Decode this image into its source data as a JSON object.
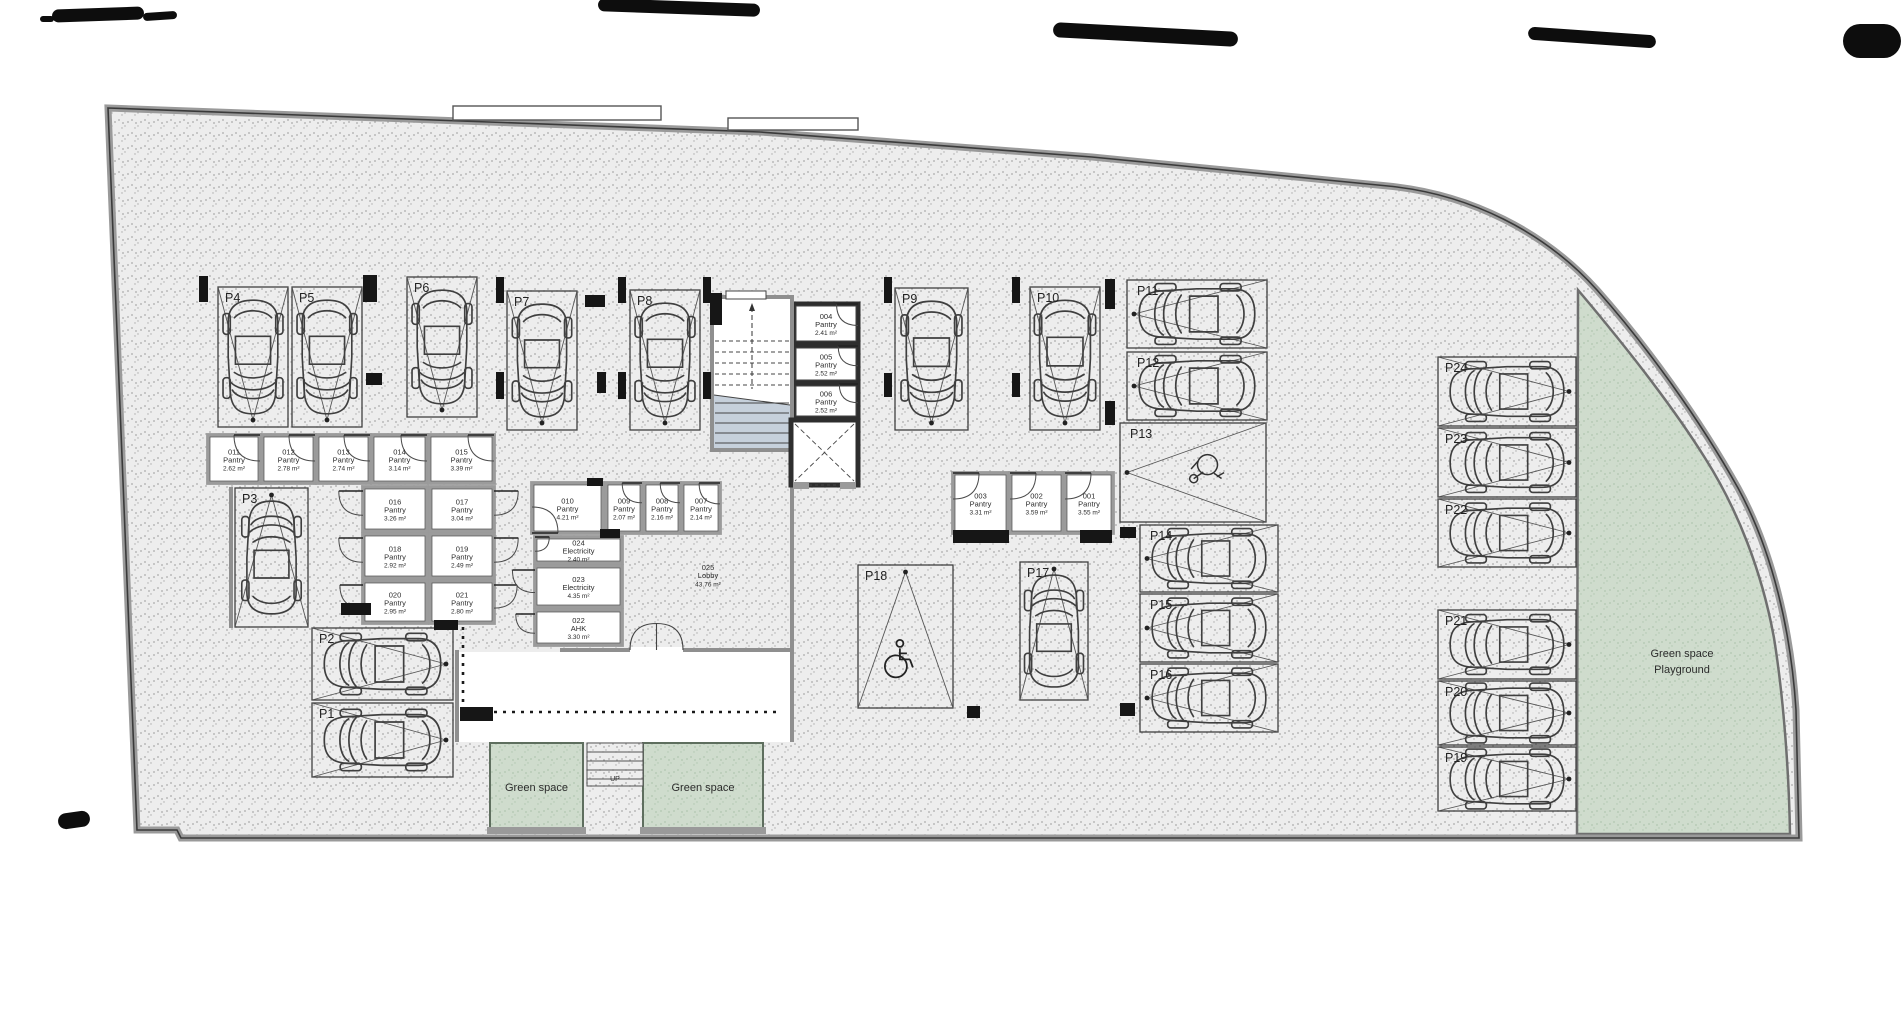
{
  "title": "Basement parking floor plan",
  "canvas": {
    "w": 1904,
    "h": 1010
  },
  "colors": {
    "paper": "#ffffff",
    "floor": "#ededed",
    "floor_dot": "#9a9a9a",
    "green": "#cfdccd",
    "green_dot": "#a9bfa7",
    "wall_gray": "#8f8f8f",
    "wall_dark": "#2e2e2e",
    "line": "#3f3f3f",
    "stair_shade": "#c6d0db",
    "ink": "#2b2b2b"
  },
  "green_playground": {
    "line1": "Green space",
    "line2": "Playground",
    "cx": 1682,
    "cy1": 657,
    "cy2": 673
  },
  "terraces": [
    {
      "label": "Green space",
      "x": 490,
      "y": 743,
      "w": 93,
      "h": 88
    },
    {
      "label": "Green space",
      "x": 643,
      "y": 743,
      "w": 120,
      "h": 88
    }
  ],
  "bottom_stairs": {
    "x": 587,
    "y": 743,
    "w": 56,
    "h": 43,
    "label": "UP"
  },
  "lobby": {
    "id": "025",
    "name": "Lobby",
    "area": "43.76 m²",
    "cx": 708,
    "cy": 578
  },
  "rooms": [
    {
      "id": "011",
      "name": "Pantry",
      "area": "2.62 m²",
      "x": 208,
      "y": 435,
      "w": 52,
      "h": 48,
      "door": "tr"
    },
    {
      "id": "012",
      "name": "Pantry",
      "area": "2.78 m²",
      "x": 262,
      "y": 435,
      "w": 53,
      "h": 48,
      "door": "tr"
    },
    {
      "id": "013",
      "name": "Pantry",
      "area": "2.74 m²",
      "x": 317,
      "y": 435,
      "w": 53,
      "h": 48,
      "door": "tr"
    },
    {
      "id": "014",
      "name": "Pantry",
      "area": "3.14 m²",
      "x": 372,
      "y": 435,
      "w": 55,
      "h": 48,
      "door": "tr"
    },
    {
      "id": "015",
      "name": "Pantry",
      "area": "3.39 m²",
      "x": 429,
      "y": 435,
      "w": 65,
      "h": 48,
      "door": "tr"
    },
    {
      "id": "016",
      "name": "Pantry",
      "area": "3.26 m²",
      "x": 363,
      "y": 487,
      "w": 64,
      "h": 44,
      "door": "lo"
    },
    {
      "id": "017",
      "name": "Pantry",
      "area": "3.04 m²",
      "x": 430,
      "y": 487,
      "w": 64,
      "h": 44,
      "door": "ro"
    },
    {
      "id": "018",
      "name": "Pantry",
      "area": "2.92 m²",
      "x": 363,
      "y": 534,
      "w": 64,
      "h": 44,
      "door": "lo"
    },
    {
      "id": "019",
      "name": "Pantry",
      "area": "2.49 m²",
      "x": 430,
      "y": 534,
      "w": 64,
      "h": 44,
      "door": "ro"
    },
    {
      "id": "020",
      "name": "Pantry",
      "area": "2.95 m²",
      "x": 363,
      "y": 581,
      "w": 64,
      "h": 42,
      "door": "lo"
    },
    {
      "id": "021",
      "name": "Pantry",
      "area": "2.80 m²",
      "x": 430,
      "y": 581,
      "w": 64,
      "h": 42,
      "door": "ro"
    },
    {
      "id": "010",
      "name": "Pantry",
      "area": "4.21 m²",
      "x": 532,
      "y": 483,
      "w": 71,
      "h": 50,
      "door": "bl"
    },
    {
      "id": "009",
      "name": "Pantry",
      "area": "2.07 m²",
      "x": 606,
      "y": 483,
      "w": 36,
      "h": 50,
      "door": "tr"
    },
    {
      "id": "008",
      "name": "Pantry",
      "area": "2.16 m²",
      "x": 644,
      "y": 483,
      "w": 36,
      "h": 50,
      "door": "tr"
    },
    {
      "id": "007",
      "name": "Pantry",
      "area": "2.14 m²",
      "x": 682,
      "y": 483,
      "w": 38,
      "h": 50,
      "door": "tr"
    },
    {
      "id": "024",
      "name": "Electricity",
      "area": "2.40 m²",
      "x": 535,
      "y": 537,
      "w": 87,
      "h": 26,
      "door": "tl"
    },
    {
      "id": "023",
      "name": "Electricity",
      "area": "4.35 m²",
      "x": 535,
      "y": 566,
      "w": 87,
      "h": 41,
      "door": "lo"
    },
    {
      "id": "022",
      "name": "AHK",
      "area": "3.30 m²",
      "x": 535,
      "y": 610,
      "w": 87,
      "h": 35,
      "door": "lo"
    },
    {
      "id": "004",
      "name": "Pantry",
      "area": "2.41 m²",
      "x": 794,
      "y": 304,
      "w": 64,
      "h": 39,
      "door": "tr",
      "dark": true
    },
    {
      "id": "005",
      "name": "Pantry",
      "area": "2.52 m²",
      "x": 794,
      "y": 346,
      "w": 64,
      "h": 36,
      "door": "tr",
      "dark": true
    },
    {
      "id": "006",
      "name": "Pantry",
      "area": "2.52 m²",
      "x": 794,
      "y": 384,
      "w": 64,
      "h": 34,
      "door": "tr",
      "dark": true
    },
    {
      "id": "003",
      "name": "Pantry",
      "area": "3.31 m²",
      "x": 953,
      "y": 473,
      "w": 55,
      "h": 60,
      "door": "tl"
    },
    {
      "id": "002",
      "name": "Pantry",
      "area": "3.59 m²",
      "x": 1010,
      "y": 473,
      "w": 53,
      "h": 60,
      "door": "tl"
    },
    {
      "id": "001",
      "name": "Pantry",
      "area": "3.55 m²",
      "x": 1065,
      "y": 473,
      "w": 48,
      "h": 60,
      "door": "tl"
    }
  ],
  "parking_spots": [
    {
      "id": "P1",
      "x": 312,
      "y": 703,
      "w": 141,
      "h": 74,
      "orient": "h",
      "apex": "right",
      "kind": "car"
    },
    {
      "id": "P2",
      "x": 312,
      "y": 628,
      "w": 141,
      "h": 72,
      "orient": "h",
      "apex": "right",
      "kind": "car"
    },
    {
      "id": "P3",
      "x": 235,
      "y": 488,
      "w": 73,
      "h": 139,
      "orient": "v",
      "apex": "up",
      "kind": "car"
    },
    {
      "id": "P4",
      "x": 218,
      "y": 287,
      "w": 70,
      "h": 140,
      "orient": "v",
      "apex": "down",
      "kind": "car"
    },
    {
      "id": "P5",
      "x": 292,
      "y": 287,
      "w": 70,
      "h": 140,
      "orient": "v",
      "apex": "down",
      "kind": "car"
    },
    {
      "id": "P6",
      "x": 407,
      "y": 277,
      "w": 70,
      "h": 140,
      "orient": "v",
      "apex": "down",
      "kind": "car"
    },
    {
      "id": "P7",
      "x": 507,
      "y": 291,
      "w": 70,
      "h": 139,
      "orient": "v",
      "apex": "down",
      "kind": "car"
    },
    {
      "id": "P8",
      "x": 630,
      "y": 290,
      "w": 70,
      "h": 140,
      "orient": "v",
      "apex": "down",
      "kind": "car"
    },
    {
      "id": "P9",
      "x": 895,
      "y": 288,
      "w": 73,
      "h": 142,
      "orient": "v",
      "apex": "down",
      "kind": "car"
    },
    {
      "id": "P10",
      "x": 1030,
      "y": 287,
      "w": 70,
      "h": 143,
      "orient": "v",
      "apex": "down",
      "kind": "car"
    },
    {
      "id": "P11",
      "x": 1127,
      "y": 280,
      "w": 140,
      "h": 68,
      "orient": "h",
      "apex": "left",
      "kind": "car"
    },
    {
      "id": "P12",
      "x": 1127,
      "y": 352,
      "w": 140,
      "h": 68,
      "orient": "h",
      "apex": "left",
      "kind": "car"
    },
    {
      "id": "P13",
      "x": 1120,
      "y": 423,
      "w": 146,
      "h": 99,
      "orient": "h",
      "apex": "left",
      "kind": "moto"
    },
    {
      "id": "P14",
      "x": 1140,
      "y": 525,
      "w": 138,
      "h": 67,
      "orient": "h",
      "apex": "left",
      "kind": "car"
    },
    {
      "id": "P15",
      "x": 1140,
      "y": 594,
      "w": 138,
      "h": 68,
      "orient": "h",
      "apex": "left",
      "kind": "car"
    },
    {
      "id": "P16",
      "x": 1140,
      "y": 664,
      "w": 138,
      "h": 68,
      "orient": "h",
      "apex": "left",
      "kind": "car"
    },
    {
      "id": "P17",
      "x": 1020,
      "y": 562,
      "w": 68,
      "h": 138,
      "orient": "v",
      "apex": "up",
      "kind": "car"
    },
    {
      "id": "P18",
      "x": 858,
      "y": 565,
      "w": 95,
      "h": 143,
      "orient": "v",
      "apex": "up",
      "kind": "wheelchair"
    },
    {
      "id": "P19",
      "x": 1438,
      "y": 747,
      "w": 138,
      "h": 64,
      "orient": "h",
      "apex": "right",
      "kind": "car"
    },
    {
      "id": "P20",
      "x": 1438,
      "y": 681,
      "w": 138,
      "h": 64,
      "orient": "h",
      "apex": "right",
      "kind": "car"
    },
    {
      "id": "P21",
      "x": 1438,
      "y": 610,
      "w": 138,
      "h": 69,
      "orient": "h",
      "apex": "right",
      "kind": "car"
    },
    {
      "id": "P22",
      "x": 1438,
      "y": 499,
      "w": 138,
      "h": 68,
      "orient": "h",
      "apex": "right",
      "kind": "car"
    },
    {
      "id": "P23",
      "x": 1438,
      "y": 428,
      "w": 138,
      "h": 69,
      "orient": "h",
      "apex": "right",
      "kind": "car"
    },
    {
      "id": "P24",
      "x": 1438,
      "y": 357,
      "w": 138,
      "h": 69,
      "orient": "h",
      "apex": "right",
      "kind": "car"
    }
  ],
  "stairwell": {
    "x": 712,
    "y": 297,
    "w": 80,
    "h": 153
  },
  "elevator": {
    "x": 791,
    "y": 420,
    "w": 67,
    "h": 65
  },
  "columns": [
    [
      199,
      276,
      9,
      26
    ],
    [
      363,
      275,
      14,
      27
    ],
    [
      496,
      277,
      8,
      26
    ],
    [
      618,
      277,
      8,
      26
    ],
    [
      703,
      277,
      8,
      26
    ],
    [
      884,
      277,
      8,
      26
    ],
    [
      1012,
      277,
      8,
      26
    ],
    [
      1105,
      279,
      10,
      30
    ],
    [
      366,
      373,
      16,
      12
    ],
    [
      496,
      372,
      8,
      27
    ],
    [
      618,
      372,
      8,
      27
    ],
    [
      703,
      372,
      8,
      27
    ],
    [
      884,
      373,
      8,
      24
    ],
    [
      1012,
      373,
      8,
      24
    ],
    [
      1105,
      401,
      10,
      24
    ],
    [
      585,
      295,
      20,
      12
    ],
    [
      597,
      372,
      9,
      21
    ],
    [
      1120,
      527,
      16,
      11
    ],
    [
      1120,
      703,
      15,
      13
    ],
    [
      341,
      603,
      30,
      12
    ],
    [
      434,
      620,
      24,
      10
    ],
    [
      587,
      478,
      16,
      8
    ],
    [
      600,
      529,
      20,
      9
    ],
    [
      953,
      530,
      56,
      13
    ],
    [
      1080,
      530,
      32,
      13
    ],
    [
      460,
      707,
      33,
      14
    ],
    [
      967,
      706,
      13,
      12
    ],
    [
      710,
      293,
      12,
      32
    ]
  ],
  "walls": [
    [
      792,
      452,
      792,
      650
    ],
    [
      560,
      650,
      630,
      650
    ],
    [
      683,
      650,
      792,
      650
    ],
    [
      231,
      487,
      231,
      628
    ],
    [
      457,
      650,
      457,
      742
    ],
    [
      792,
      650,
      792,
      742
    ]
  ],
  "dotted_lines": [
    [
      463,
      582,
      463,
      710
    ],
    [
      467,
      712,
      780,
      712
    ]
  ],
  "canopies": [
    [
      453,
      106,
      208,
      14
    ],
    [
      728,
      118,
      130,
      12
    ]
  ],
  "lobby_door": {
    "x1": 630,
    "x2": 683,
    "y": 650
  },
  "smudges": [
    [
      52,
      8,
      92,
      13,
      -2
    ],
    [
      143,
      12,
      34,
      8,
      -4
    ],
    [
      598,
      1,
      162,
      13,
      2
    ],
    [
      1053,
      27,
      185,
      15,
      3
    ],
    [
      1528,
      31,
      128,
      13,
      4
    ],
    [
      1843,
      24,
      58,
      34,
      0
    ],
    [
      58,
      812,
      32,
      16,
      -8
    ],
    [
      40,
      16,
      14,
      6,
      0
    ]
  ]
}
